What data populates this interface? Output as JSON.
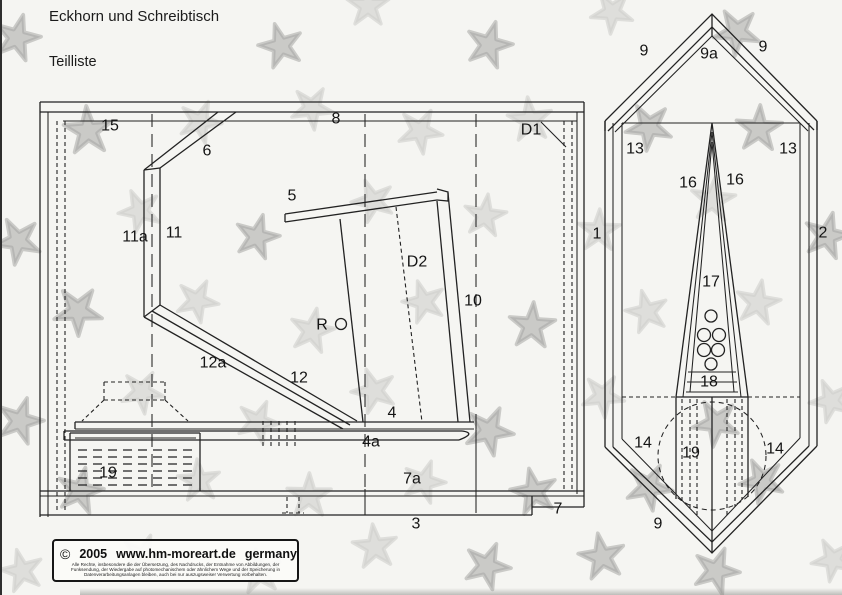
{
  "page": {
    "title": "Eckhorn und Schreibtisch",
    "subtitle": "Teilliste",
    "background": "#f5f5f2",
    "line_color": "#222222"
  },
  "side_view": {
    "description": "side elevation of corner desk",
    "labels": [
      {
        "text": "15",
        "x": 110,
        "y": 125
      },
      {
        "text": "8",
        "x": 336,
        "y": 118
      },
      {
        "text": "D1",
        "x": 531,
        "y": 129
      },
      {
        "text": "6",
        "x": 207,
        "y": 150
      },
      {
        "text": "5",
        "x": 292,
        "y": 195
      },
      {
        "text": "11a",
        "x": 135,
        "y": 236
      },
      {
        "text": "11",
        "x": 174,
        "y": 232
      },
      {
        "text": "D2",
        "x": 417,
        "y": 261
      },
      {
        "text": "10",
        "x": 473,
        "y": 300
      },
      {
        "text": "R",
        "x": 322,
        "y": 324
      },
      {
        "text": "12a",
        "x": 213,
        "y": 362
      },
      {
        "text": "12",
        "x": 299,
        "y": 377
      },
      {
        "text": "4",
        "x": 392,
        "y": 412
      },
      {
        "text": "4a",
        "x": 371,
        "y": 441
      },
      {
        "text": "19",
        "x": 108,
        "y": 472
      },
      {
        "text": "7a",
        "x": 412,
        "y": 478
      },
      {
        "text": "3",
        "x": 416,
        "y": 523
      },
      {
        "text": "7",
        "x": 558,
        "y": 508
      }
    ]
  },
  "top_view": {
    "description": "plan view of corner unit",
    "labels": [
      {
        "text": "9",
        "x": 644,
        "y": 50
      },
      {
        "text": "9a",
        "x": 709,
        "y": 53
      },
      {
        "text": "9",
        "x": 763,
        "y": 46
      },
      {
        "text": "13",
        "x": 635,
        "y": 148
      },
      {
        "text": "13",
        "x": 788,
        "y": 148
      },
      {
        "text": "16",
        "x": 688,
        "y": 182
      },
      {
        "text": "16",
        "x": 735,
        "y": 179
      },
      {
        "text": "1",
        "x": 597,
        "y": 233
      },
      {
        "text": "2",
        "x": 823,
        "y": 232
      },
      {
        "text": "17",
        "x": 711,
        "y": 281
      },
      {
        "text": "18",
        "x": 709,
        "y": 381
      },
      {
        "text": "14",
        "x": 643,
        "y": 442
      },
      {
        "text": "14",
        "x": 775,
        "y": 448
      },
      {
        "text": "19",
        "x": 691,
        "y": 452
      },
      {
        "text": "9",
        "x": 658,
        "y": 523
      }
    ]
  },
  "copyright": {
    "symbol": "©",
    "year": "2005",
    "site": "www.hm-moreart.de",
    "country": "germany",
    "fine_print_lines": [
      "Alle Rechte, insbesondere die der Übersetzung, des Nachdrucks, der Entnahme von Abbildungen, der",
      "Funksendung, der Wiedergabe auf photomechanischem oder ähnlichem Wege und der Speicherung in",
      "Datenverarbeitungsanlagen bleiben, auch bei nur auszugsweiser Verwertung vorbehalten."
    ]
  },
  "watermark": {
    "tones": {
      "d": "#a6a6a4",
      "l": "#cfcfcc"
    },
    "stars": [
      [
        17,
        38,
        24,
        15,
        "d"
      ],
      [
        281,
        46,
        23,
        200,
        "d"
      ],
      [
        368,
        6,
        22,
        0,
        "l"
      ],
      [
        489,
        45,
        24,
        160,
        "d"
      ],
      [
        612,
        12,
        22,
        40,
        "l"
      ],
      [
        737,
        32,
        24,
        185,
        "d"
      ],
      [
        88,
        131,
        25,
        140,
        "d"
      ],
      [
        200,
        122,
        22,
        310,
        "l"
      ],
      [
        312,
        108,
        22,
        30,
        "l"
      ],
      [
        420,
        131,
        23,
        100,
        "l"
      ],
      [
        530,
        120,
        23,
        210,
        "l"
      ],
      [
        649,
        127,
        24,
        330,
        "d"
      ],
      [
        759,
        129,
        24,
        75,
        "d"
      ],
      [
        18,
        241,
        24,
        260,
        "d"
      ],
      [
        140,
        211,
        22,
        120,
        "l"
      ],
      [
        257,
        237,
        23,
        15,
        "d"
      ],
      [
        373,
        201,
        22,
        195,
        "l"
      ],
      [
        485,
        216,
        22,
        80,
        "l"
      ],
      [
        599,
        231,
        22,
        290,
        "l"
      ],
      [
        713,
        200,
        23,
        150,
        "l"
      ],
      [
        827,
        236,
        24,
        230,
        "d"
      ],
      [
        78,
        311,
        25,
        35,
        "d"
      ],
      [
        197,
        301,
        22,
        170,
        "l"
      ],
      [
        312,
        331,
        23,
        300,
        "l"
      ],
      [
        424,
        302,
        22,
        55,
        "l"
      ],
      [
        532,
        326,
        24,
        220,
        "d"
      ],
      [
        647,
        312,
        22,
        130,
        "l"
      ],
      [
        758,
        303,
        23,
        10,
        "l"
      ],
      [
        20,
        421,
        24,
        305,
        "d"
      ],
      [
        142,
        392,
        22,
        245,
        "l"
      ],
      [
        258,
        422,
        22,
        95,
        "l"
      ],
      [
        374,
        391,
        23,
        340,
        "l"
      ],
      [
        489,
        431,
        25,
        25,
        "d"
      ],
      [
        603,
        396,
        22,
        175,
        "l"
      ],
      [
        716,
        423,
        24,
        115,
        "d"
      ],
      [
        831,
        401,
        22,
        265,
        "l"
      ],
      [
        80,
        491,
        24,
        85,
        "d"
      ],
      [
        199,
        481,
        22,
        355,
        "l"
      ],
      [
        309,
        496,
        23,
        145,
        "l"
      ],
      [
        424,
        482,
        22,
        235,
        "l"
      ],
      [
        534,
        492,
        24,
        60,
        "d"
      ],
      [
        649,
        487,
        24,
        315,
        "d"
      ],
      [
        762,
        481,
        23,
        190,
        "d"
      ],
      [
        22,
        571,
        22,
        130,
        "l"
      ],
      [
        143,
        556,
        22,
        20,
        "l"
      ],
      [
        259,
        572,
        23,
        280,
        "l"
      ],
      [
        375,
        547,
        23,
        210,
        "l"
      ],
      [
        487,
        566,
        24,
        95,
        "d"
      ],
      [
        602,
        557,
        24,
        350,
        "d"
      ],
      [
        716,
        571,
        24,
        165,
        "d"
      ],
      [
        833,
        560,
        22,
        45,
        "l"
      ]
    ]
  }
}
